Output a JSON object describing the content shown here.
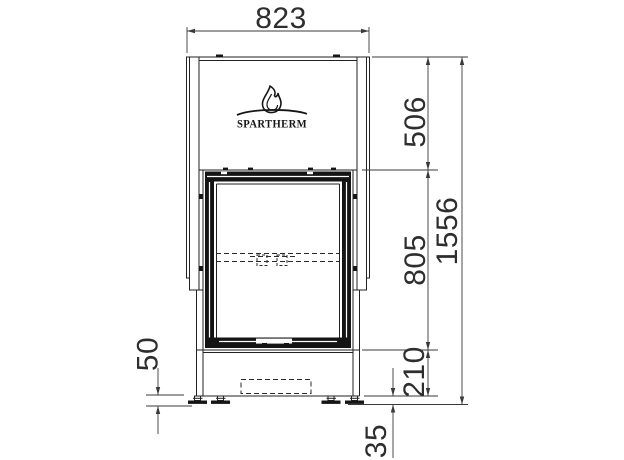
{
  "drawing": {
    "background_color": "#ffffff",
    "line_color": "#1f1f1f",
    "dimension_color": "#3a3a3a"
  },
  "logo": {
    "name": "SPARTHERM",
    "flame_icon": "flame"
  },
  "dimensions": {
    "overall_width": "823",
    "hood_height": "506",
    "door_height": "805",
    "overall_height": "1556",
    "base_height": "210",
    "floor_clearance": "35",
    "foot_adjustment": "50"
  }
}
